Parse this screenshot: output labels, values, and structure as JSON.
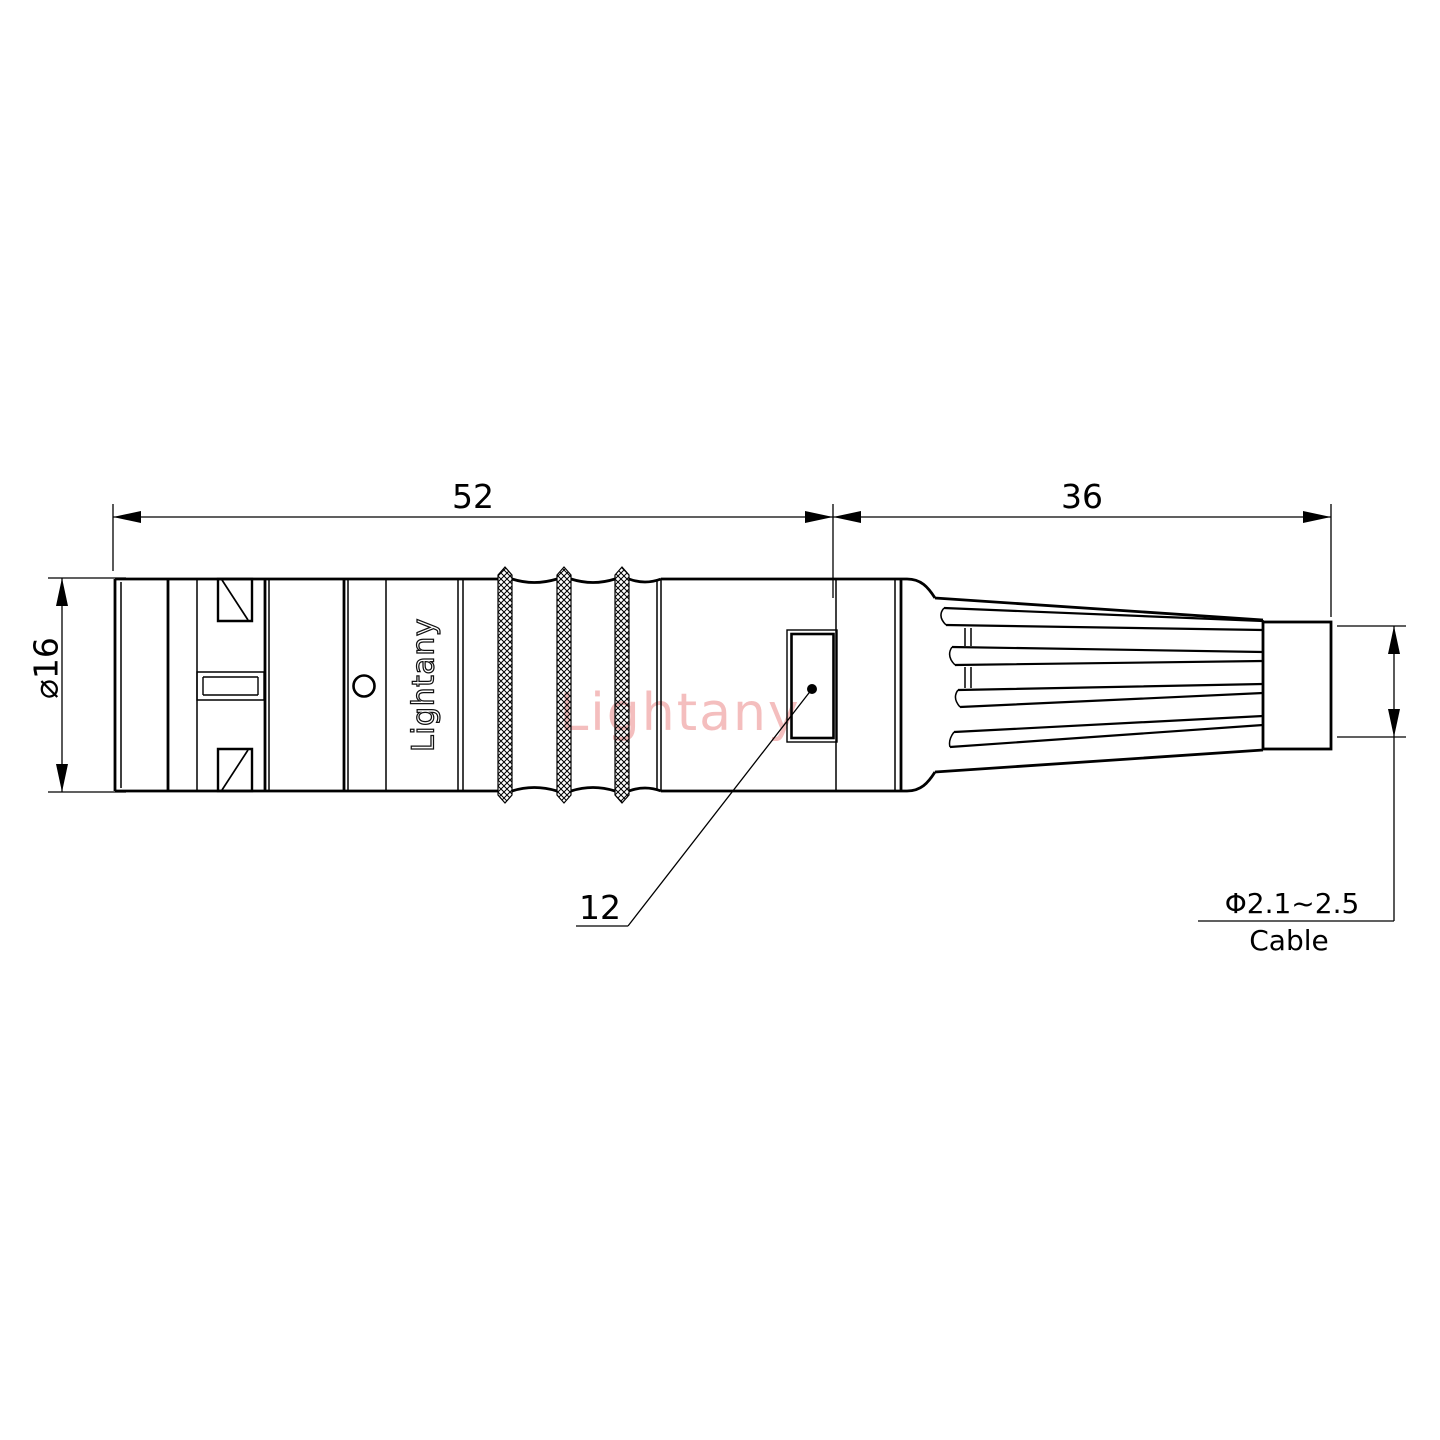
{
  "drawing": {
    "kind": "connector-technical-drawing",
    "views": "side view with strain relief boot and cable entry"
  },
  "labels": {
    "dim_body_length": "52",
    "dim_boot_length": "36",
    "dim_body_diameter": "⌀16",
    "ref_number": "12",
    "cable_diameter": "Φ2.1~2.5",
    "cable": "Cable",
    "brand_marking": "Lightany",
    "watermark": "Lightany"
  },
  "colors": {
    "line": "#000000",
    "watermark_pink": "#f3b8b8",
    "background": "#ffffff"
  }
}
